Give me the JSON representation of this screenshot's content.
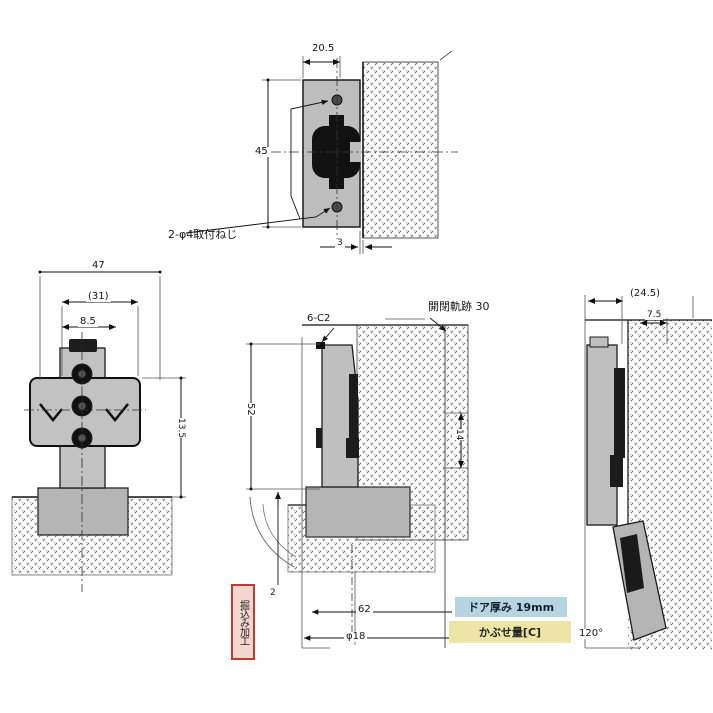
{
  "top_view": {
    "dim_width": "20.5",
    "dim_height": "45",
    "dim_gap": "3",
    "screw_note": "2-φ4取付ねじ"
  },
  "front_view": {
    "dim_total": "47",
    "dim_pitch": "(31)",
    "dim_offset": "8.5",
    "dim_side": "13.5"
  },
  "closed_view": {
    "chamfer": "6-C2",
    "trace": "開閉軌跡 30",
    "dim_height": "52",
    "dim_depth": "14",
    "dim_a": "62",
    "dim_b": "φ18",
    "dim_c": "2"
  },
  "open_view": {
    "dim_a": "(24.5)",
    "dim_b": "7.5",
    "angle": "120°"
  },
  "notes": {
    "red": "掘込み加工",
    "blue": "ドア厚み 19mm",
    "yellow": "かぶせ量[C]"
  },
  "colors": {
    "red_border": "#bf3b2a",
    "blue_bg": "#b7d4e2",
    "yellow_bg": "#ece5a5",
    "metal_gray": "#c0c0c0",
    "line": "#1a1a1a"
  }
}
